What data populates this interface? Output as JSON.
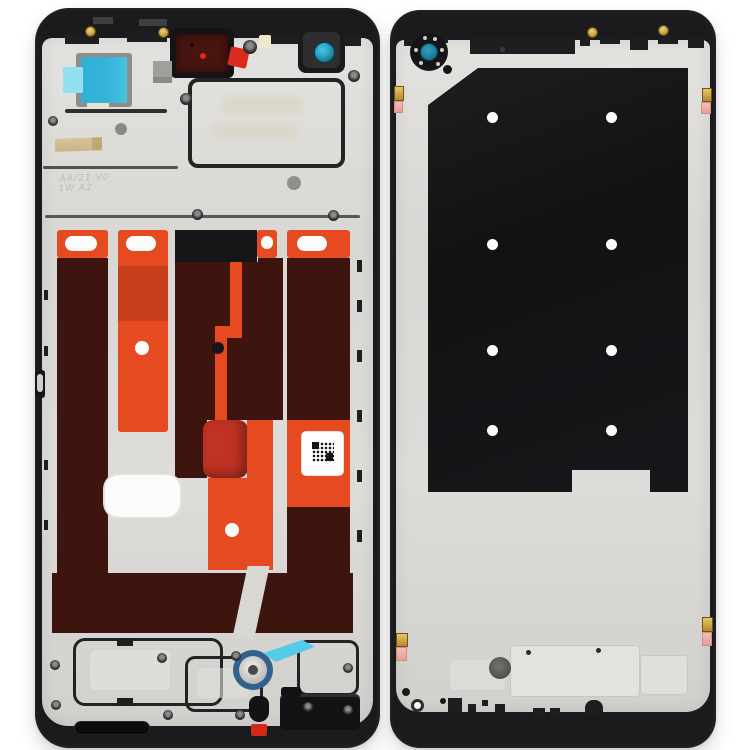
{
  "image": {
    "alt": "Product photo of a smartphone middle frame housing: front side (left, with orange and dark-red adhesive strips) and back side (right, with black inner plate and screw holes) on a white background"
  },
  "palette": {
    "bg": "#ffffff",
    "frame_black": "#1b1b1d",
    "frame_black_soft": "#2c2c2f",
    "plate_silver": "#d8d7d4",
    "plate_light": "#e6e5e2",
    "plate_shadow": "#bfbebb",
    "adhesive_orange": "#e64a20",
    "adhesive_dark": "#3d140e",
    "adhesive_crimson": "#c03224",
    "earpiece_maroon": "#471410",
    "cam_teal": "#2aa6c4",
    "cam_teal_dark": "#0f617e",
    "sticker_cyan": "#35b4d8",
    "sticker_cyan_light": "#93e0f2",
    "gold": "#c9a33f",
    "pink": "#f2b0a7",
    "red_dot": "#e0251c",
    "gray_chip": "#a09f9c"
  },
  "markings": {
    "stamp_line1": "AA/21 V0",
    "stamp_line2": "1W A2"
  }
}
